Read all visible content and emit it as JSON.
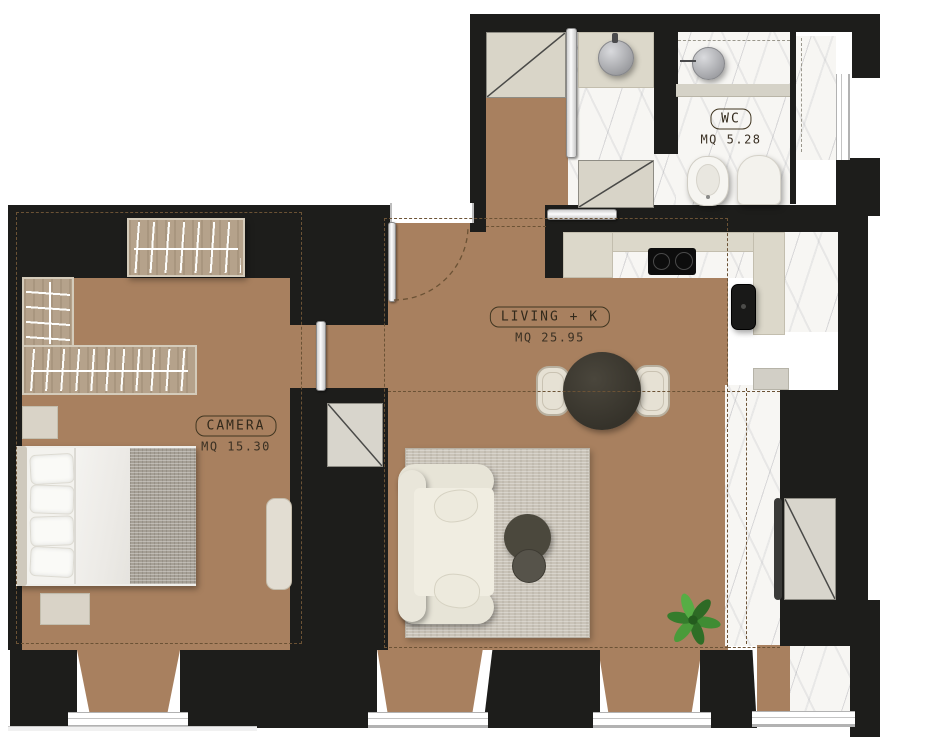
{
  "rooms": {
    "camera": {
      "label": "CAMERA",
      "area": "MQ 15.30"
    },
    "living": {
      "label": "LIVING + K",
      "area": "MQ 25.95"
    },
    "wc": {
      "label": "WC",
      "area": "MQ 5.28"
    }
  },
  "materials": {
    "wall_color": "#1d1d1b",
    "parquet_color": "#a8805f",
    "marble_color": "#f7f6f3",
    "counter_color": "#dcd8ca",
    "rug_color": "#c9c3b8",
    "table_color": "#3b382f",
    "plant_color": "#3f8c33"
  }
}
